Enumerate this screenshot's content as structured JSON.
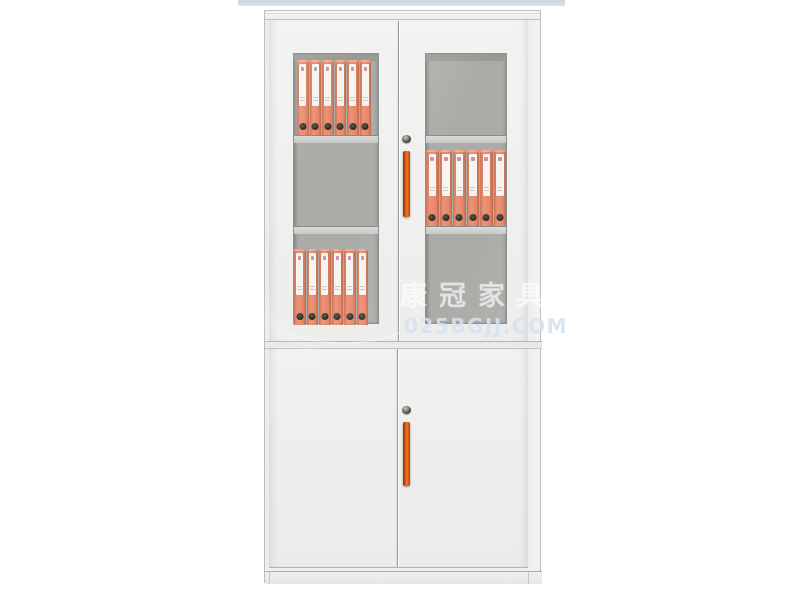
{
  "scene": {
    "type": "product-photo",
    "subject": "Two-section white steel office filing cabinet: upper glass swing doors with shelves of orange lever-arch binders, lower solid doors, vertical orange handles and round cam locks",
    "background_color": "#ffffff",
    "top_strip_color": "#c9d4e2"
  },
  "watermark": {
    "brand_text": "康冠家具",
    "url_text": "025BGJJ.COM"
  },
  "cabinet": {
    "colors": {
      "body": "#f0f0ee",
      "interior": "#abaca8",
      "binder": "#ee9476",
      "handle": "#e2590f"
    },
    "upper_shelves": [
      {
        "door": "left",
        "level": "top",
        "binders": 6
      },
      {
        "door": "right",
        "level": "middle",
        "binders": 6
      },
      {
        "door": "left",
        "level": "bottom",
        "binders": 6
      }
    ],
    "hardware": {
      "locks": 2,
      "handles": 2
    }
  }
}
